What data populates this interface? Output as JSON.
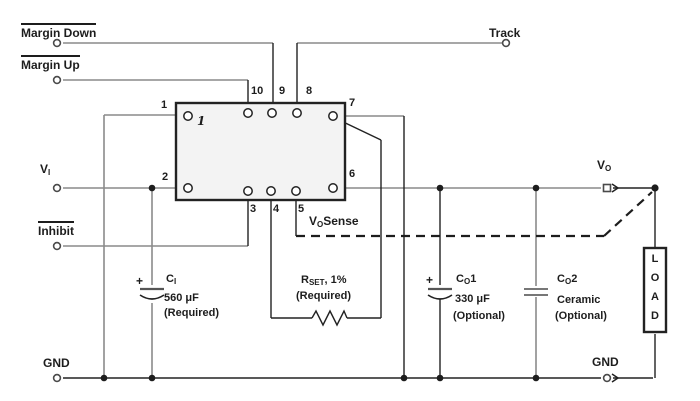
{
  "labels": {
    "margin_down": "Margin Down",
    "margin_up": "Margin Up",
    "track": "Track",
    "vi_base": "V",
    "vi_sub": "I",
    "inhibit": "Inhibit",
    "vo_base": "V",
    "vo_sub": "O",
    "vosense_base": "V",
    "vosense_sub": "O",
    "vosense_rest": "Sense",
    "gnd_left": "GND",
    "gnd_right": "GND"
  },
  "pins": {
    "p1": "1",
    "p2": "2",
    "p3": "3",
    "p4": "4",
    "p5": "5",
    "p6": "6",
    "p7": "7",
    "p8": "8",
    "p9": "9",
    "p10": "10",
    "inner_mark": "1"
  },
  "components": {
    "ci_name": "C",
    "ci_sub": "I",
    "ci_value": "560 μF",
    "ci_note": "(Required)",
    "ci_plus": "+",
    "rset_name": "R",
    "rset_sub": "SET",
    "rset_rest": ", 1%",
    "rset_note": "(Required)",
    "co1_name": "C",
    "co1_sub": "O",
    "co1_idx": "1",
    "co1_value": "330 μF",
    "co1_note": "(Optional)",
    "co1_plus": "+",
    "co2_name": "C",
    "co2_sub": "O",
    "co2_idx": "2",
    "co2_value": "Ceramic",
    "co2_note": "(Optional)",
    "load_letters": [
      "L",
      "O",
      "A",
      "D"
    ]
  },
  "colors": {
    "wire_gray": "#8a8a8a",
    "line_black": "#222222",
    "ic_fill": "#f3f3f3",
    "background": "#ffffff"
  }
}
